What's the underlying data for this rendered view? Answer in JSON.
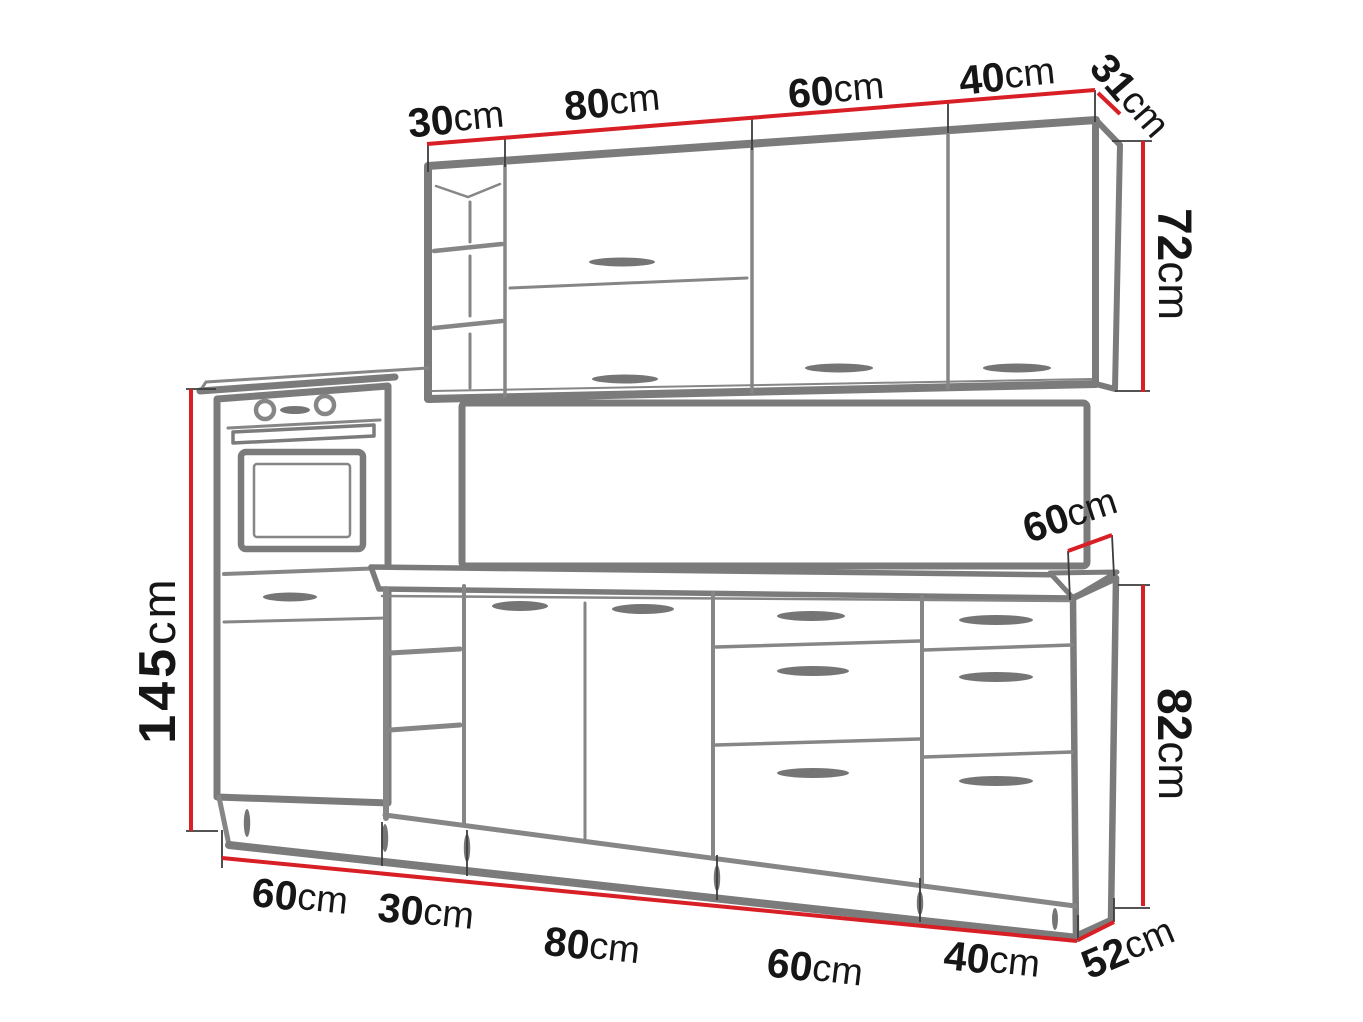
{
  "diagram": {
    "kind": "kitchen-set-dimension-drawing",
    "unit": "cm",
    "colors": {
      "dimension_line": "#d81f26",
      "cabinet_outline": "#7b7b7b",
      "label_text": "#161616",
      "background": "#ffffff"
    },
    "dims": {
      "wall_top": [
        {
          "num": "30",
          "unit": "cm"
        },
        {
          "num": "80",
          "unit": "cm"
        },
        {
          "num": "60",
          "unit": "cm"
        },
        {
          "num": "40",
          "unit": "cm"
        }
      ],
      "wall_depth": {
        "num": "31",
        "unit": "cm"
      },
      "wall_height": {
        "num": "72",
        "unit": "cm"
      },
      "tall_height": {
        "num": "145",
        "unit": "cm"
      },
      "counter_depth": {
        "num": "60",
        "unit": "cm"
      },
      "base_height": {
        "num": "82",
        "unit": "cm"
      },
      "base_bottom": [
        {
          "num": "60",
          "unit": "cm"
        },
        {
          "num": "30",
          "unit": "cm"
        },
        {
          "num": "80",
          "unit": "cm"
        },
        {
          "num": "60",
          "unit": "cm"
        },
        {
          "num": "40",
          "unit": "cm"
        }
      ],
      "base_side_depth": {
        "num": "52",
        "unit": "cm"
      }
    }
  }
}
